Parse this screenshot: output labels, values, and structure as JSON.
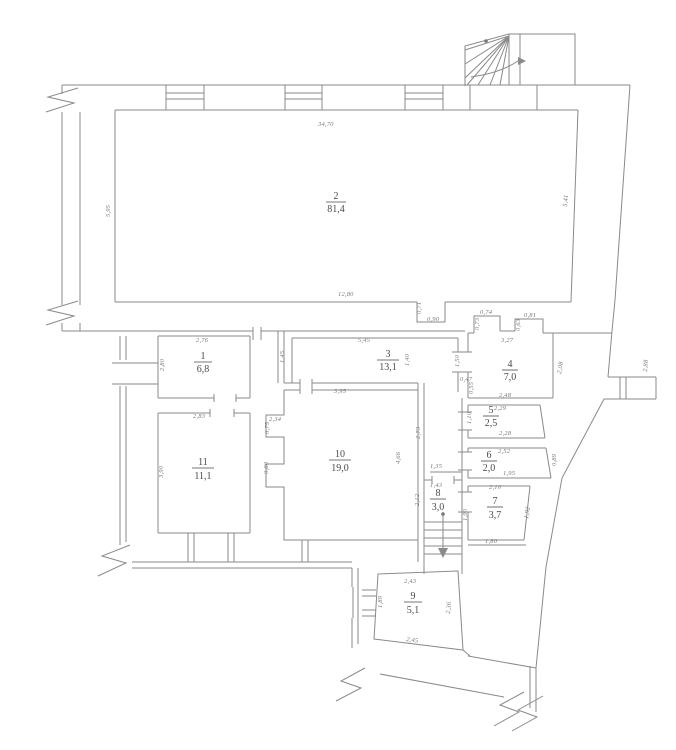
{
  "rooms": {
    "r1": {
      "number": "1",
      "area": "6,8"
    },
    "r2": {
      "number": "2",
      "area": "81,4"
    },
    "r3": {
      "number": "3",
      "area": "13,1"
    },
    "r4": {
      "number": "4",
      "area": "7,0"
    },
    "r5": {
      "number": "5",
      "area": "2,5"
    },
    "r6": {
      "number": "6",
      "area": "2,0"
    },
    "r7": {
      "number": "7",
      "area": "3,7"
    },
    "r8": {
      "number": "8",
      "area": "3,0"
    },
    "r9": {
      "number": "9",
      "area": "5,1"
    },
    "r10": {
      "number": "10",
      "area": "19,0"
    },
    "r11": {
      "number": "11",
      "area": "11,1"
    }
  },
  "dims": {
    "r2_top": "34,70",
    "r2_left": "5,95",
    "r2_right": "5,41",
    "r2_bottom": "12,80",
    "notch_v": "0,71",
    "notch_h": "0,90",
    "r1_top": "2,76",
    "r1_left": "2,80",
    "c13": "1,45",
    "r3_top": "5,45",
    "r3_right": "1,40",
    "door34": "1,50",
    "door34_w": "0,47",
    "r4_n1": "0,74",
    "r4_n1v": "0,73",
    "r4_n2": "0,81",
    "r4_n2v": "0,63",
    "r4_top": "3,27",
    "r4_right": "2,08",
    "r4_bottom": "2,48",
    "r4_left": "0,55",
    "ext_right": "2,88",
    "r5_top": "2,29",
    "r5_left": "1,10",
    "r5_bottom": "2,28",
    "r6_top": "2,52",
    "r6_bottom": "1,95",
    "r6_right": "0,89",
    "r7_top": "2,10",
    "r7_left": "1,90",
    "r7_right": "1,92",
    "r7_bottom": "1,80",
    "r8_above": "1,35",
    "r8_top": "1,43",
    "r8_left": "2,12",
    "r9_top": "2,43",
    "r9_left": "1,89",
    "r9_right": "2,36",
    "r9_bottom": "2,45",
    "r10_top": "3,95",
    "r10_n1": "2,34",
    "r10_n1v": "0,75",
    "r10_n2v": "0,80",
    "r10_right": "4,66",
    "c10": "2,73",
    "r11_top": "2,83",
    "r11_left": "3,90"
  }
}
